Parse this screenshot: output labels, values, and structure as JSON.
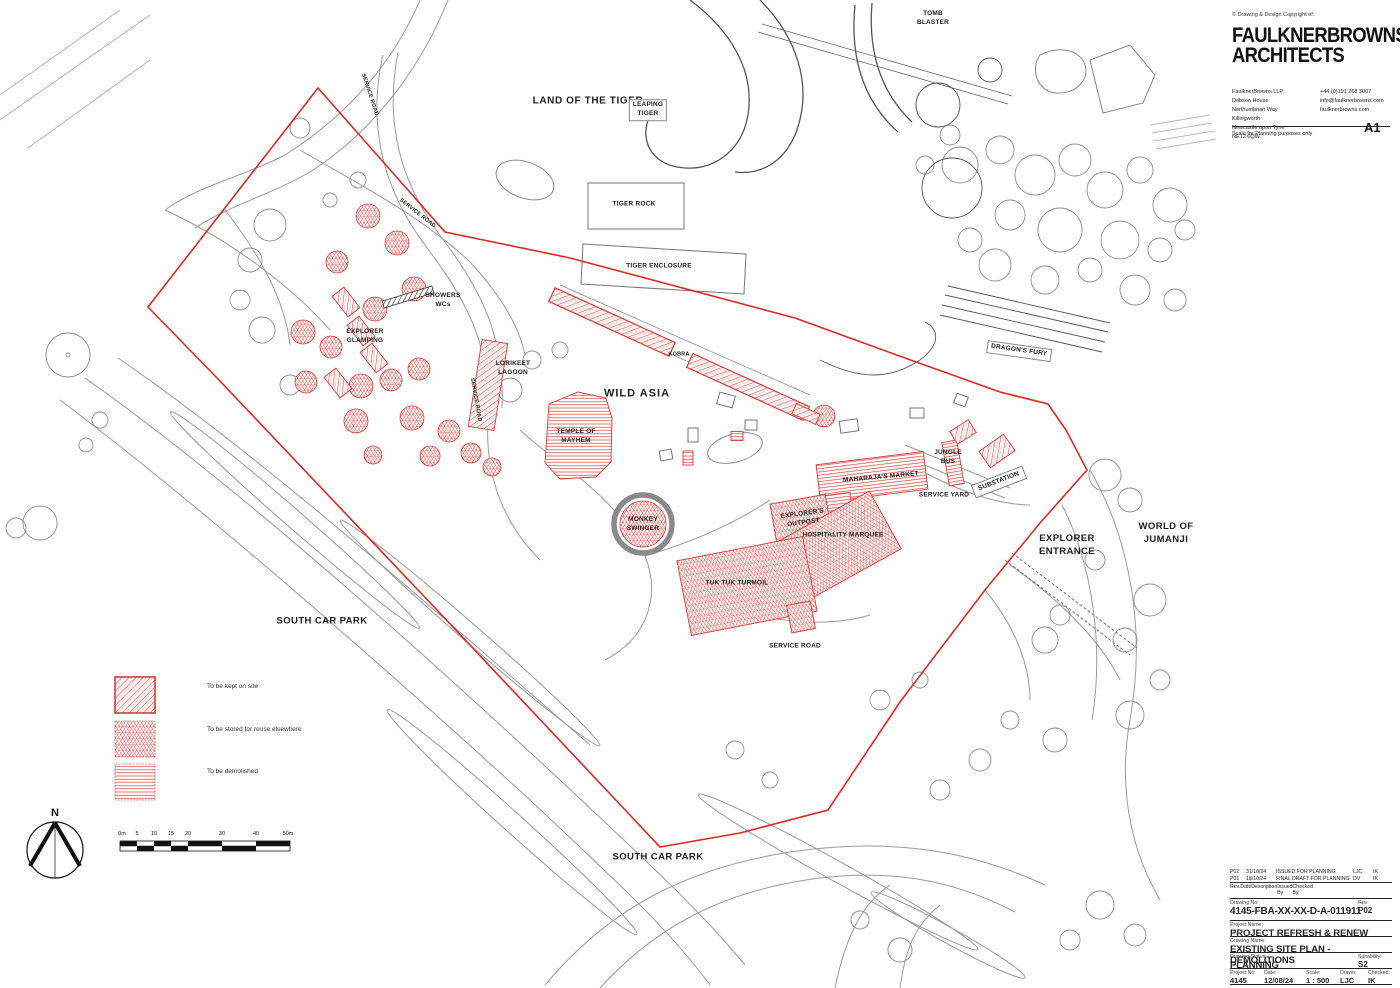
{
  "sheet": {
    "copyright": "© Drawing & Design Copyright of:",
    "firm_name": "FAULKNERBROWNS\nARCHITECTS",
    "address": "FaulknerBrowns LLP\nDobson House\nNorthumbrian Way\nKillingworth\nNewcastle upon Tyne\nNE12 6QW",
    "contact": "+44 (0)191 268 3007\ninfo@faulknerbrowns.com\nfaulknerbrowns.com",
    "scale_note": "Scale for Planning purposes only",
    "paper_size": "A1"
  },
  "title_block": {
    "revisions": [
      {
        "rev": "P02",
        "date": "31/10/24",
        "description": "ISSUED FOR PLANNING",
        "issued_by": "LJC",
        "checked_by": "IK"
      },
      {
        "rev": "P01",
        "date": "18/10/24",
        "description": "FINAL DRAFT FOR PLANNING",
        "issued_by": "DV",
        "checked_by": "IK"
      }
    ],
    "headers": {
      "rev": "Rev.",
      "date": "Date",
      "description": "Description",
      "issued": "Issued\nBy",
      "checked": "Checked\nBy"
    },
    "drawing_no_label": "Drawing No:",
    "drawing_no": "4145-FBA-XX-XX-D-A-011911",
    "rev_label": "Rev:",
    "rev": "P02",
    "project_name_label": "Project Name:",
    "project_name": "PROJECT REFRESH & RENEW",
    "drawing_name_label": "Drawing Name:",
    "drawing_name": "EXISTING SITE PLAN - DEMOLITIONS",
    "status_label": "Drawing Status:",
    "status": "PLANNING",
    "suitability_label": "Suitability:",
    "suitability": "S2",
    "project_no_label": "Project No:",
    "project_no": "4145",
    "date_label": "Date:",
    "date": "12/08/24",
    "scale_label": "Scale:",
    "scale": "1 : 500",
    "drawn_label": "Drawn:",
    "drawn": "LJC",
    "checked_label": "Checked:",
    "checked": "IK"
  },
  "legend": {
    "items": [
      {
        "key": "kept",
        "label": "To be kept on site"
      },
      {
        "key": "stored",
        "label": "To be stored for reuse elsewhere"
      },
      {
        "key": "demolished",
        "label": "To be demolished"
      }
    ]
  },
  "scale_bar": {
    "ticks": [
      "0m",
      "5",
      "10",
      "15",
      "20",
      "30",
      "40",
      "50m"
    ]
  },
  "north_label": "N",
  "map": {
    "labels": [
      {
        "text": "LAND OF THE TIGER"
      },
      {
        "text": "LEAPING\nTIGER"
      },
      {
        "text": "TOMB\nBLASTER"
      },
      {
        "text": "TIGER ROCK"
      },
      {
        "text": "TIGER ENCLOSURE"
      },
      {
        "text": "SERVICE ROAD"
      },
      {
        "text": "SERVICE ROAD"
      },
      {
        "text": "SERVICE ROAD"
      },
      {
        "text": "SERVICE ROAD"
      },
      {
        "text": "SHOWERS\nWCs"
      },
      {
        "text": "EXPLORER\nGLAMPING"
      },
      {
        "text": "LORIKEET\nLAGOON"
      },
      {
        "text": "KOBRA"
      },
      {
        "text": "WILD ASIA"
      },
      {
        "text": "TEMPLE OF\nMAYHEM"
      },
      {
        "text": "MAHARAJA'S MARKET"
      },
      {
        "text": "JUNGLE\nBUS"
      },
      {
        "text": "SERVICE YARD"
      },
      {
        "text": "SUBSTATION"
      },
      {
        "text": "EXPLORER'S\nOUTPOST"
      },
      {
        "text": "HOSPITALITY MARQUEE"
      },
      {
        "text": "MONKEY\nSWINGER"
      },
      {
        "text": "TUK TUK TURMOIL"
      },
      {
        "text": "DRAGON'S FURY"
      },
      {
        "text": "EXPLORER\nENTRANCE"
      },
      {
        "text": "WORLD OF\nJUMANJI"
      },
      {
        "text": "SOUTH CAR PARK"
      },
      {
        "text": "SOUTH CAR PARK"
      }
    ]
  },
  "colors": {
    "demolition_red": "#d93a35",
    "boundary_red": "#d92b26",
    "line_grey": "#8f8f8f",
    "ink": "#1d1d1d"
  }
}
